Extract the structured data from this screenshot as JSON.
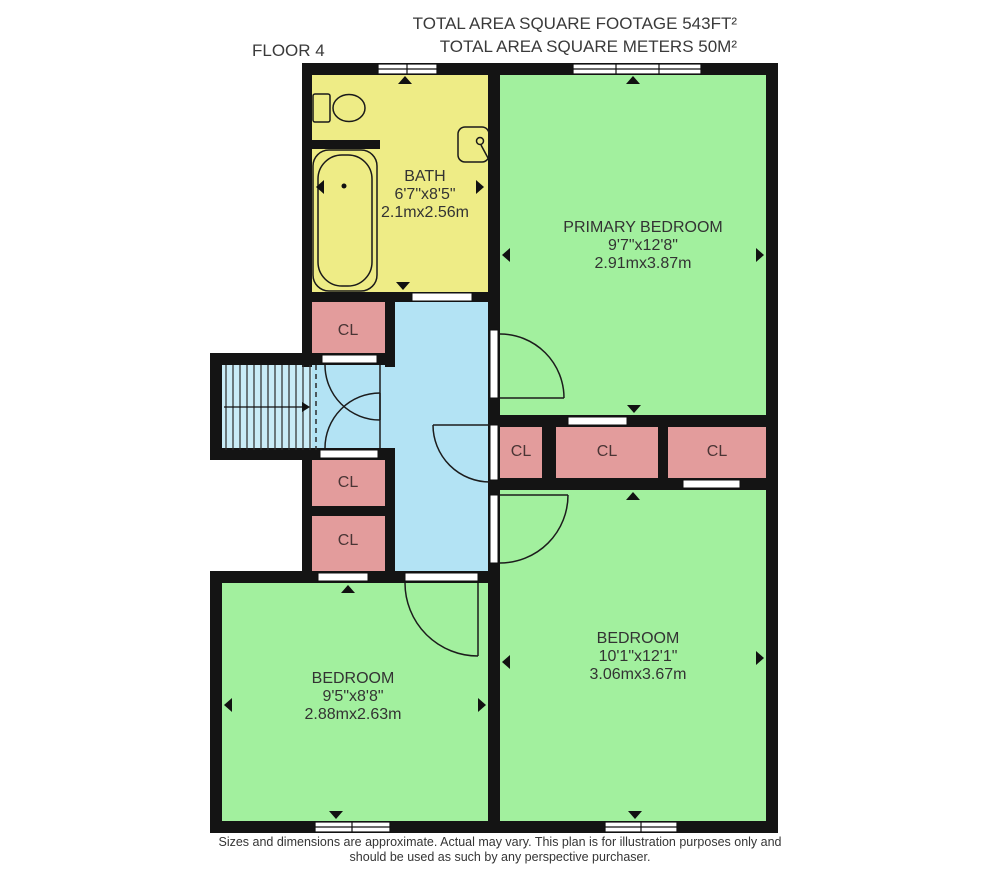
{
  "header": {
    "floor_label": "FLOOR 4",
    "total_area_ft": "TOTAL AREA SQUARE FOOTAGE 543FT²",
    "total_area_m": "TOTAL AREA SQUARE METERS 50M²"
  },
  "rooms": {
    "bath": {
      "name": "BATH",
      "dim_ft": "6'7\"x8'5\"",
      "dim_m": "2.1mx2.56m"
    },
    "primary_bedroom": {
      "name": "PRIMARY BEDROOM",
      "dim_ft": "9'7\"x12'8\"",
      "dim_m": "2.91mx3.87m"
    },
    "bedroom_left": {
      "name": "BEDROOM",
      "dim_ft": "9'5\"x8'8\"",
      "dim_m": "2.88mx2.63m"
    },
    "bedroom_right": {
      "name": "BEDROOM",
      "dim_ft": "10'1\"x12'1\"",
      "dim_m": "3.06mx3.67m"
    },
    "closet_labels": [
      "CL",
      "CL",
      "CL",
      "CL",
      "CL",
      "CL"
    ]
  },
  "footer": {
    "line1": "Sizes and dimensions are approximate. Actual may vary. This plan is for illustration purposes only and",
    "line2": "should be used as such by any perspective purchaser."
  },
  "colors": {
    "wall": "#141414",
    "bath": "#eeec86",
    "bedroom": "#a2f09e",
    "closet": "#e39c9c",
    "hallway": "#b3e3f4",
    "stairs": "#c9ecf7"
  }
}
